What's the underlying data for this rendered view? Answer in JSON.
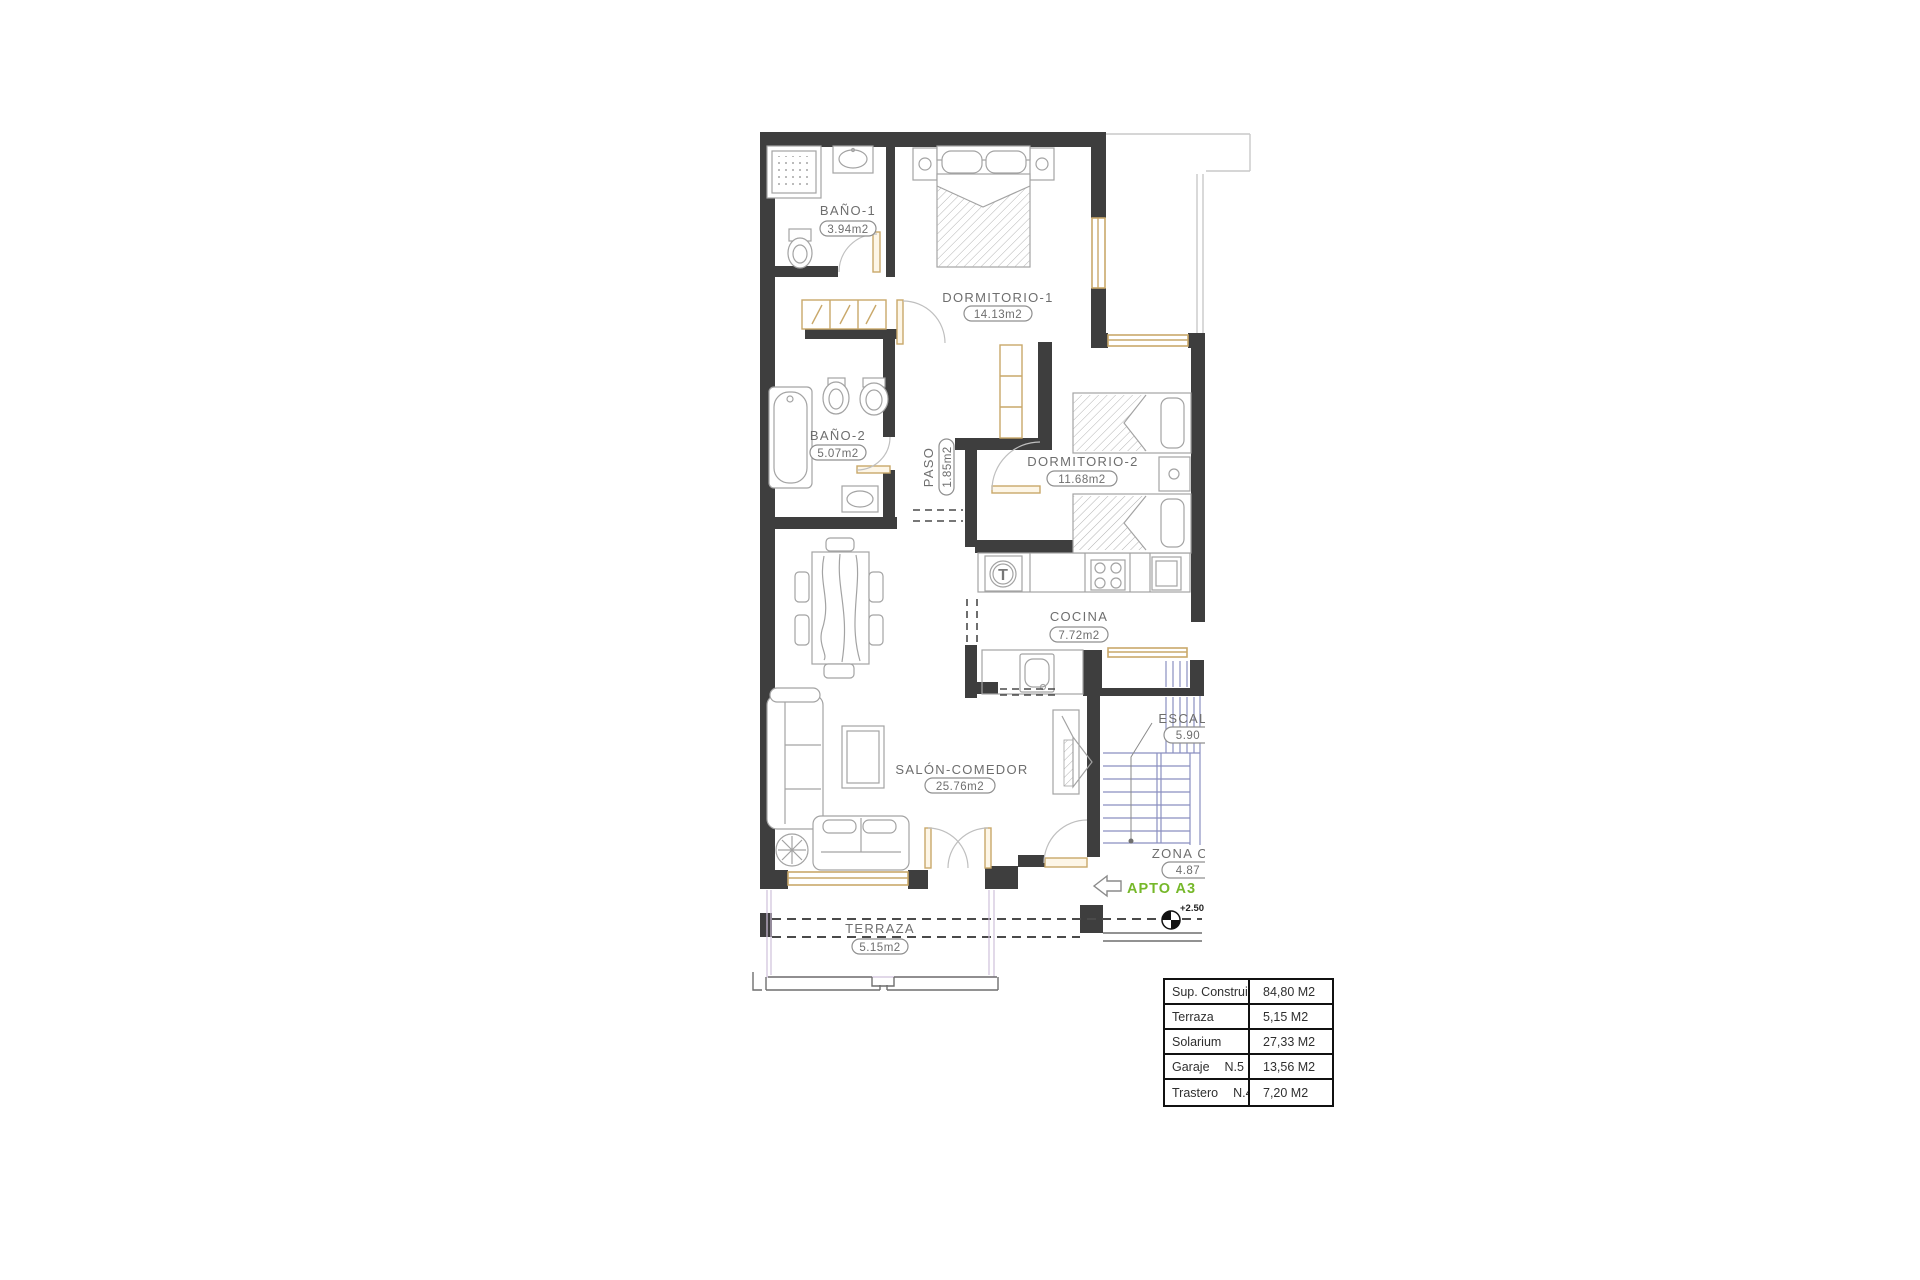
{
  "plan": {
    "rooms": [
      {
        "id": "bano1",
        "label": "BAÑO-1",
        "area": "3.94m2"
      },
      {
        "id": "dormitorio1",
        "label": "DORMITORIO-1",
        "area": "14.13m2"
      },
      {
        "id": "bano2",
        "label": "BAÑO-2",
        "area": "5.07m2"
      },
      {
        "id": "paso",
        "label": "PASO",
        "area": "1.85m2"
      },
      {
        "id": "dormitorio2",
        "label": "DORMITORIO-2",
        "area": "11.68m2"
      },
      {
        "id": "cocina",
        "label": "COCINA",
        "area": "7.72m2"
      },
      {
        "id": "salon",
        "label": "SALÓN-COMEDOR",
        "area": "25.76m2"
      },
      {
        "id": "terraza",
        "label": "TERRAZA",
        "area": "5.15m2"
      },
      {
        "id": "escalera",
        "label": "ESCAL",
        "area": "5.90"
      },
      {
        "id": "zona_comun",
        "label": "ZONA C",
        "area": "4.87"
      }
    ],
    "apartment_tag": "APTO A3",
    "level_marker": "+2.50",
    "washer_symbol": "T"
  },
  "summary_table": {
    "rows": [
      {
        "label": "Sup. Construida",
        "value": "84,80 M2"
      },
      {
        "label": "Terraza",
        "value": "5,15 M2"
      },
      {
        "label": "Solarium",
        "value": "27,33 M2"
      },
      {
        "label": "Garaje",
        "number": "N.5",
        "value": "13,56 M2"
      },
      {
        "label": "Trastero",
        "number": "N.4",
        "value": "7,20 M2"
      }
    ]
  },
  "colors": {
    "wall": "#3e3e3e",
    "furn": "#a3a3a3",
    "tan": "#c9a86a",
    "stairs": "#8a8fc0",
    "label": "#6e6e6e",
    "dash": "#4a4a4a",
    "terraza": "#cfc0da",
    "green": "#76b82a",
    "ink": "#1c1c1c"
  }
}
